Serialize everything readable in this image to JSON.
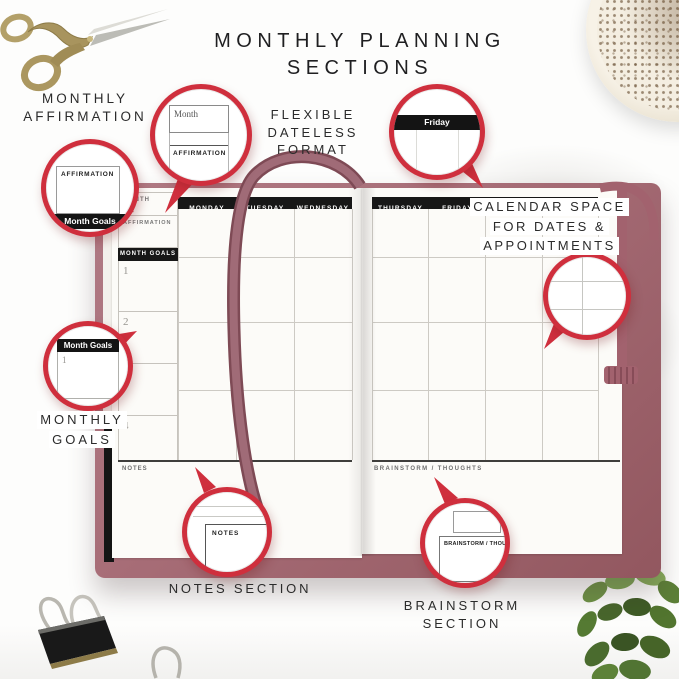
{
  "title": {
    "line1": "MONTHLY PLANNING",
    "line2": "SECTIONS"
  },
  "annotations": {
    "monthly_affirmation": {
      "line1": "MONTHLY",
      "line2": "AFFIRMATION"
    },
    "flexible_format": {
      "line1": "FLEXIBLE",
      "line2": "DATELESS FORMAT"
    },
    "calendar_space": {
      "line1": "CALENDAR SPACE",
      "line2": "FOR DATES &",
      "line3": "APPOINTMENTS"
    },
    "monthly_goals": {
      "line1": "MONTHLY",
      "line2": "GOALS"
    },
    "notes_section": {
      "line1": "NOTES SECTION"
    },
    "brainstorm_section": {
      "line1": "BRAINSTORM",
      "line2": "SECTION"
    }
  },
  "planner": {
    "left_page": {
      "month_label": "MONTH",
      "affirmation_label": "AFFIRMATION",
      "month_goals_label": "MONTH GOALS",
      "goal_numbers": [
        "1",
        "2",
        "3",
        "4"
      ],
      "day_headers": [
        "MONDAY",
        "TUESDAY",
        "WEDNESDAY"
      ],
      "notes_label": "NOTES"
    },
    "right_page": {
      "day_headers": [
        "THURSDAY",
        "FRIDAY",
        "SATURDAY"
      ],
      "brainstorm_label": "BRAINSTORM / THOUGHTS"
    }
  },
  "callouts": {
    "month_affirmation_zoom": {
      "month_box": "Month",
      "section_header": "AFFIRMATION"
    },
    "affirmation_goals_zoom": {
      "section_header": "AFFIRMATION",
      "bar_label": "Month Goals"
    },
    "friday_zoom": {
      "bar_label": "Friday"
    },
    "month_goals_zoom": {
      "bar_label": "Month Goals",
      "goal_number": "1"
    },
    "notes_zoom": {
      "section_header": "NOTES"
    },
    "brainstorm_zoom": {
      "section_header": "BRAINSTORM / THOUGH"
    }
  },
  "decor": {
    "top_left": "stork-embroidery-scissors",
    "top_right": "cappuccino-cup",
    "bottom_left": "binder-clip",
    "bottom_right": "green-plant"
  },
  "colors": {
    "accent_red": "#cf2f3d",
    "cover_mauve": "#a86e78",
    "ribbon": "#9b5d68",
    "header_black": "#171717",
    "page": "#fcfbf8"
  }
}
